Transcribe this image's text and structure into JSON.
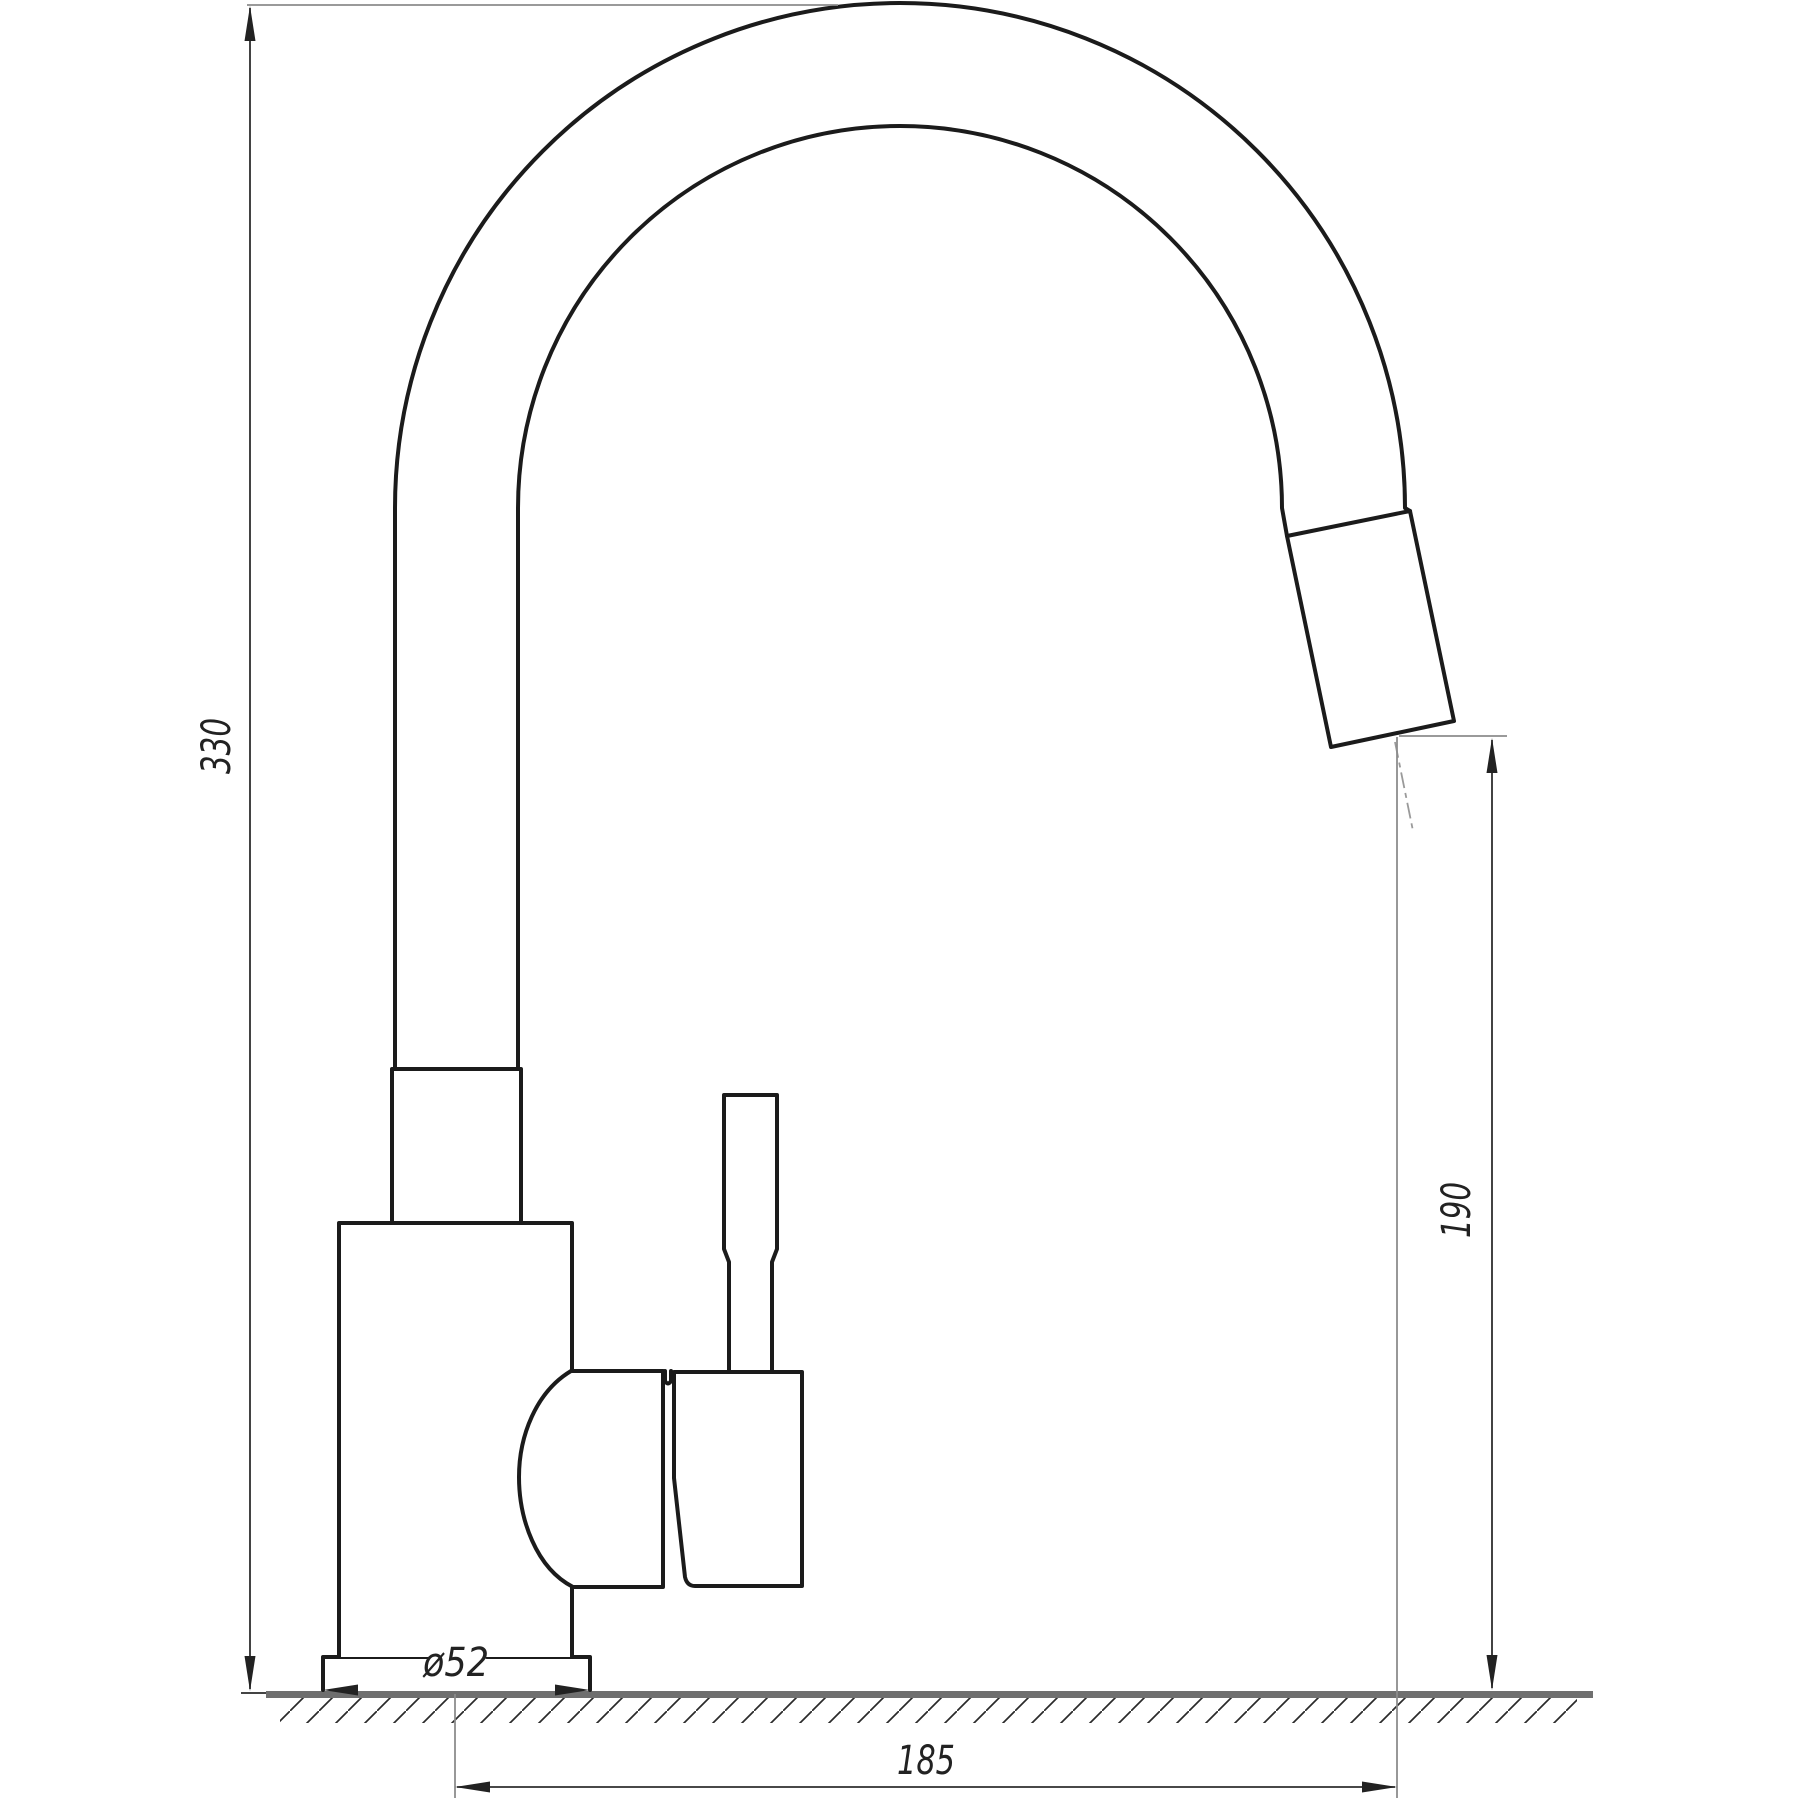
{
  "drawing": {
    "type": "technical-drawing",
    "subject": "single-lever kitchen faucet with high arc spout, side view with mounting surface",
    "dimensions": {
      "overall_height": {
        "label": "330",
        "orientation": "vertical",
        "side": "left"
      },
      "outlet_height": {
        "label": "190",
        "orientation": "vertical",
        "side": "right"
      },
      "spout_reach": {
        "label": "185",
        "orientation": "horizontal",
        "side": "bottom"
      },
      "base_diameter": {
        "label": "ø52",
        "orientation": "horizontal",
        "side": "base"
      }
    },
    "colors": {
      "outline": "#1b1b1b",
      "dimension_line": "#2e2e2e",
      "extension_line": "#8c8c8c",
      "ground_line": "#6f6f6f",
      "background": "#ffffff"
    }
  }
}
